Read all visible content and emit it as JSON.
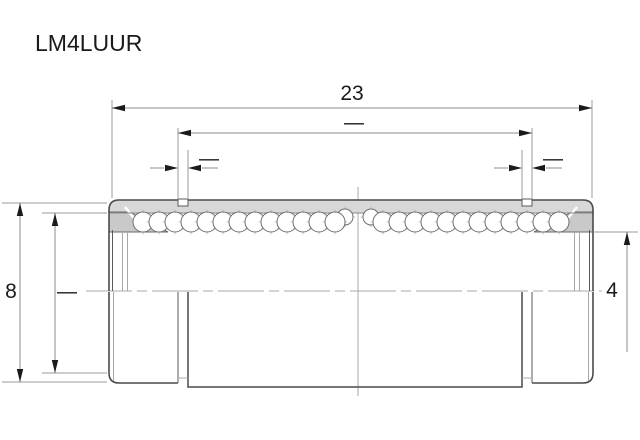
{
  "title": "LM4LUUR",
  "dimensions": {
    "overall_length": "23",
    "groove_span": "—",
    "left_groove_width": "—",
    "right_groove_width": "—",
    "outer_diameter": "8",
    "seal_outer_diameter": "—",
    "bore_diameter": "4"
  },
  "colors": {
    "background": "#ffffff",
    "outline": "#4a4a4a",
    "section_fill": "#d8d8d8",
    "seal_fill": "#c9c9c9",
    "dim_line": "#8c8c8c",
    "extension_line": "#9b9b9b",
    "arrow": "#1a1a1a",
    "text": "#1a1a1a",
    "ball_stroke": "#6e6e6e",
    "crosshair": "#b8b8b8"
  },
  "drawing": {
    "ball_rows": [
      {
        "cy": 222,
        "r": 10,
        "start": 143,
        "step": 16,
        "count": 13
      },
      {
        "cy": 222,
        "r": 10,
        "start": 383,
        "step": 16,
        "count": 12
      }
    ],
    "transition_balls": [
      {
        "cx": 345,
        "cy": 217,
        "r": 8
      },
      {
        "cx": 371,
        "cy": 217,
        "r": 8
      }
    ]
  }
}
